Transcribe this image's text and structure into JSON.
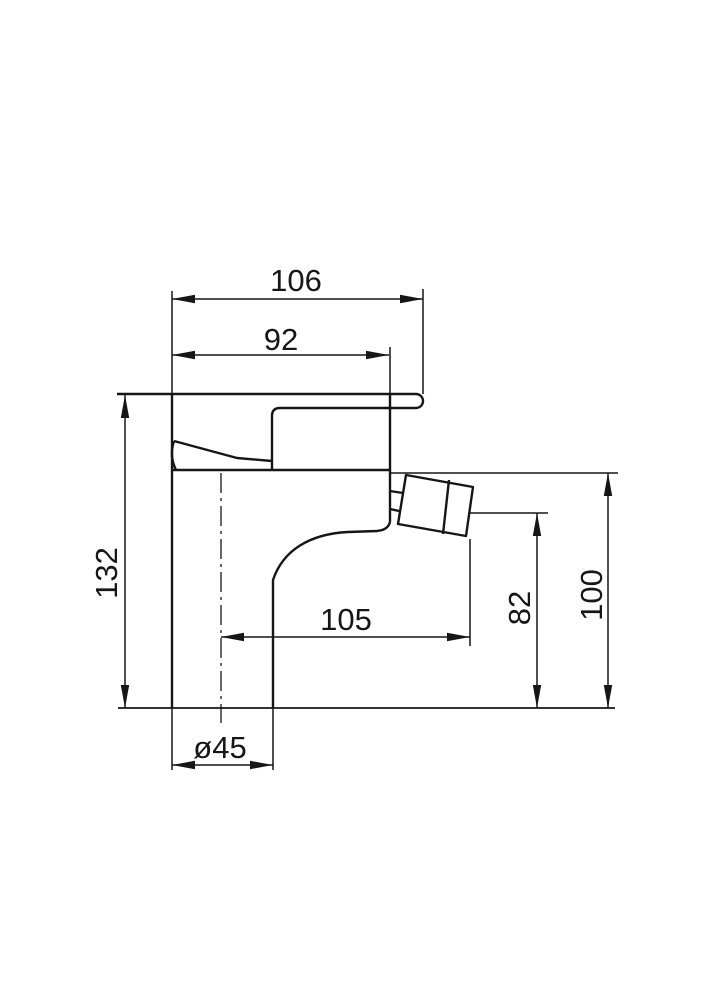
{
  "page": {
    "background_color": "#ffffff",
    "line_color": "#161616"
  },
  "drawing": {
    "kind": "technical dimension drawing",
    "subject": "single-lever mixer tap, side elevation",
    "labels": {
      "dim_106": "106",
      "dim_92": "92",
      "dim_132": "132",
      "dim_105": "105",
      "dim_82": "82",
      "dim_100": "100",
      "dim_45": "ø45"
    }
  }
}
